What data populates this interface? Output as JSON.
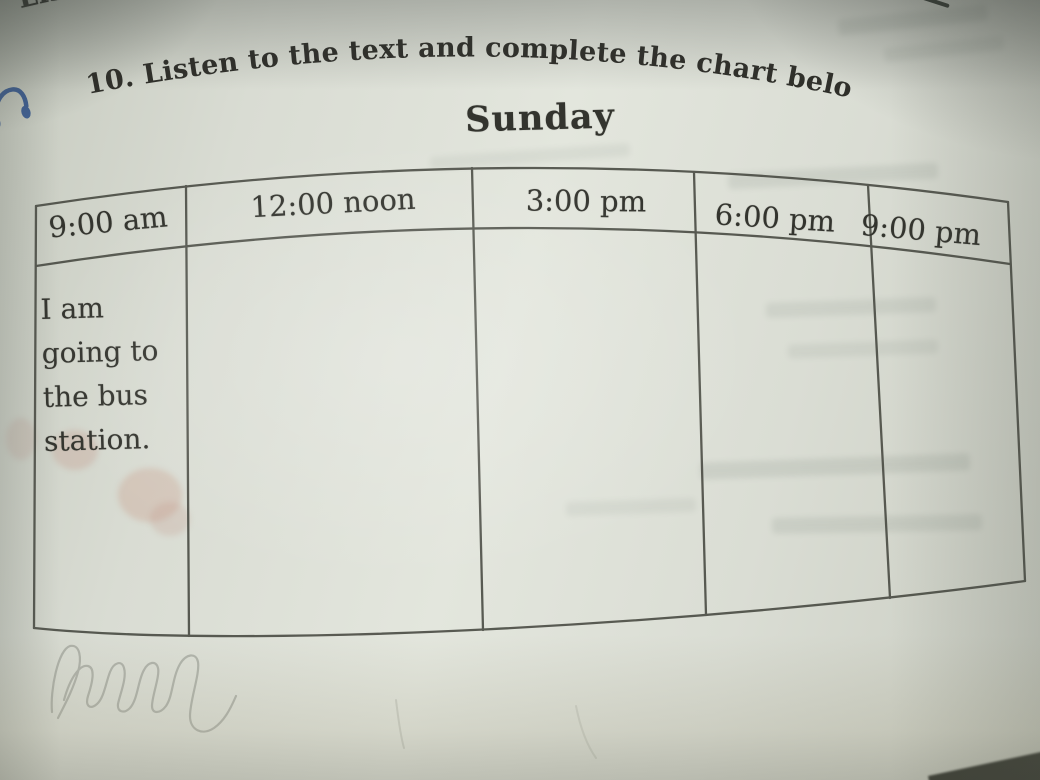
{
  "page": {
    "section_label": "Listening",
    "exercise_instruction": "10. Listen to the text and complete the chart below."
  },
  "chart_data": {
    "type": "table",
    "title": "Sunday",
    "columns": [
      "9:00 am",
      "12:00 noon",
      "3:00 pm",
      "6:00 pm",
      "9:00 pm"
    ],
    "rows": [
      [
        "I am going to the bus station.",
        "",
        "",
        "",
        ""
      ]
    ]
  },
  "icons": {
    "headphones": {
      "name": "headphones-icon",
      "glyph": "🎧",
      "color": "#3d5f96"
    }
  },
  "annotations": {
    "handwriting": "illegible pencil scribble below the table"
  },
  "colors": {
    "page_light": "#e3e6dd",
    "page_shade": "#c9ccc1",
    "ink": "#33342e",
    "table_line": "#45473f",
    "pencil": "#8d9088",
    "headphones_blue": "#3d5f96"
  }
}
